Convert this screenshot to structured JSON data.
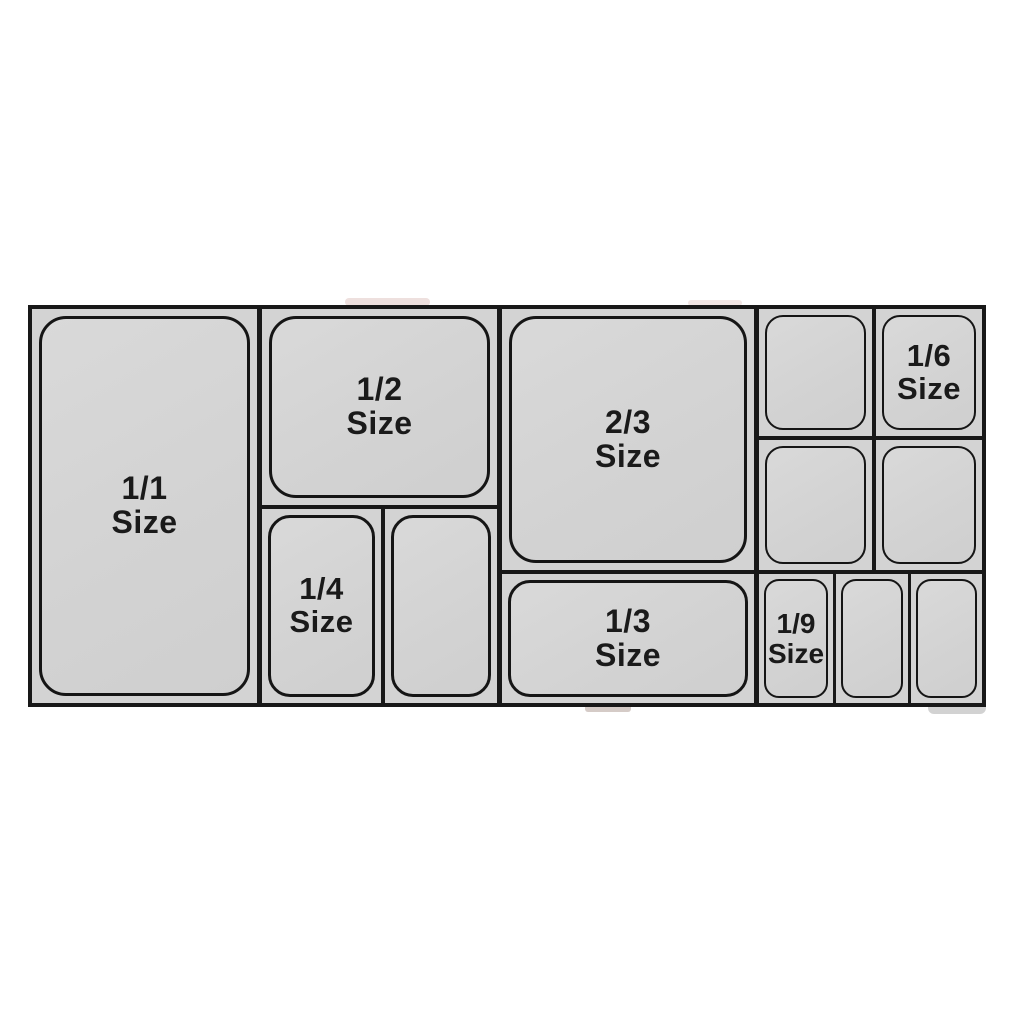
{
  "diagram": {
    "description_colors": {
      "line": "#181818",
      "pan_fill": "#d3d3d3",
      "page_background": "#ffffff",
      "label_text": "#1a1a1a"
    },
    "pans": {
      "full": {
        "fraction": "1/1",
        "word": "Size"
      },
      "half": {
        "fraction": "1/2",
        "word": "Size"
      },
      "two_thirds": {
        "fraction": "2/3",
        "word": "Size"
      },
      "third": {
        "fraction": "1/3",
        "word": "Size"
      },
      "quarter": {
        "fraction": "1/4",
        "word": "Size"
      },
      "sixth": {
        "fraction": "1/6",
        "word": "Size"
      },
      "ninth": {
        "fraction": "1/9",
        "word": "Size"
      }
    }
  }
}
